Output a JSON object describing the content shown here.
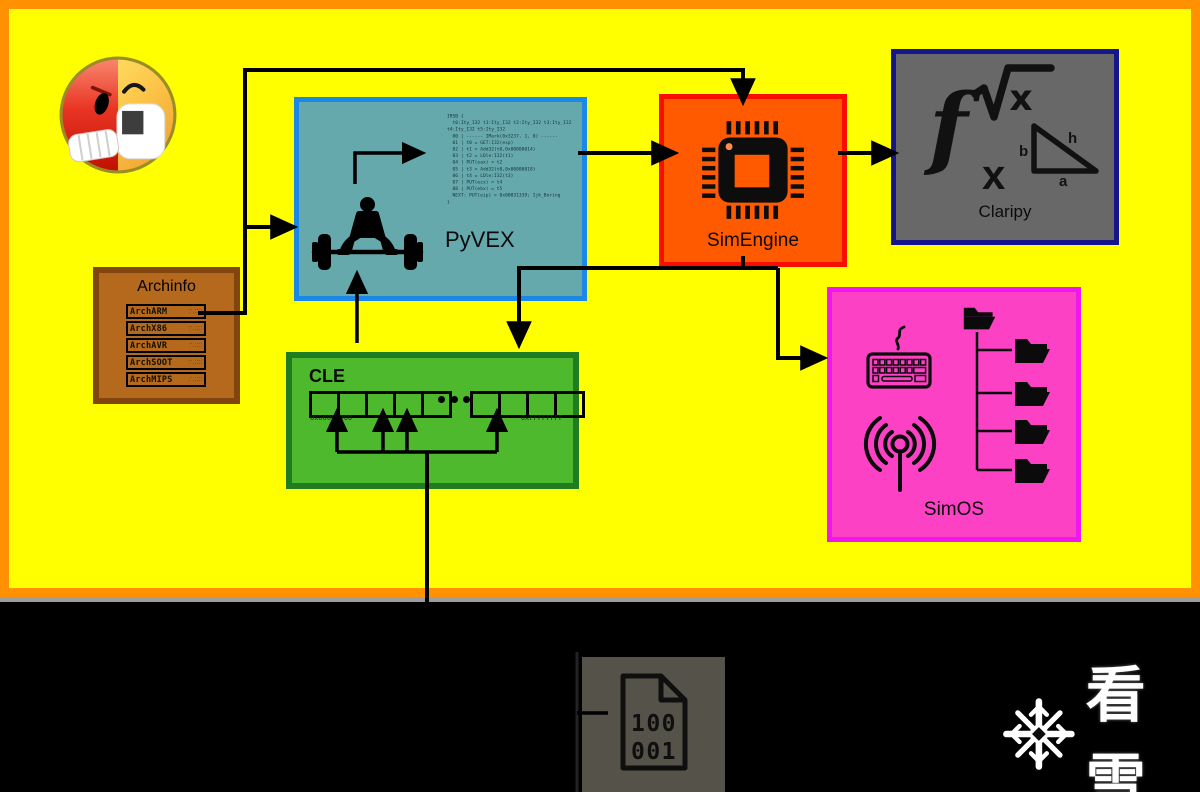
{
  "logo": {
    "icon": "angr-angry-face-icon"
  },
  "archinfo": {
    "title": "Archinfo",
    "rows": [
      {
        "label": "ArchARM",
        "detail": [
          "·· ····",
          "· ·····"
        ]
      },
      {
        "label": "ArchX86",
        "detail": [
          "·· ····",
          "· ·····"
        ]
      },
      {
        "label": "ArchAVR",
        "detail": [
          "·· ····",
          "· ·····"
        ]
      },
      {
        "label": "ArchSOOT",
        "detail": [
          "·· ····",
          "· ·····"
        ]
      },
      {
        "label": "ArchMIPS",
        "detail": [
          "·· ····",
          "· ·····"
        ]
      }
    ]
  },
  "pyvex": {
    "label": "PyVEX",
    "icon": "weightlifter-icon",
    "code": [
      "IRSB {",
      "  t0:Ity_I32 t1:Ity_I32 t2:Ity_I32 t3:Ity_I32",
      "t4:Ity_I32 t5:Ity_I32",
      "  00 | ------ IMark(0x3237, 1, 0) ------",
      "  01 | t0 = GET:I32(esp)",
      "  02 | t1 = Add32(t0,0x00000014)",
      "  03 | t2 = LDle:I32(t1)",
      "  04 | PUT(eax) = t2",
      "  05 | t3 = Add32(t0,0x00000018)",
      "  06 | t4 = LDle:I32(t3)",
      "  07 | PUT(ecx) = t4",
      "  08 | PUT(ebx) = t5",
      "  NEXT: PUT(eip) = 0x00031339; Ijk_Boring",
      "}"
    ]
  },
  "simengine": {
    "label": "SimEngine",
    "icon": "cpu-chip-icon"
  },
  "claripy": {
    "label": "Claripy",
    "icons": [
      "fx-function-icon",
      "sqrt-x-icon",
      "right-triangle-icon"
    ],
    "fx": "f",
    "fx_sub": "x",
    "sqrt_x": "x",
    "triangle": {
      "b": "b",
      "h": "h",
      "a": "a"
    }
  },
  "cle": {
    "label": "CLE",
    "icon": "memory-segments-icon",
    "addr_low": "0x00000000",
    "addr_high": "0xFFFFFFFF"
  },
  "simos": {
    "label": "SimOS",
    "icons": [
      "keyboard-icon",
      "antenna-signal-icon",
      "folder-tree-icon"
    ]
  },
  "binary_file": {
    "icon": "binary-file-icon",
    "line1": "100",
    "line2": "001"
  },
  "watermark": {
    "icon": "snowflake-icon",
    "text": "看雪"
  },
  "colors": {
    "background": "#FFFF00",
    "frame": "#FF9102",
    "pyvex_fill": "#66A9AD",
    "pyvex_border": "#1B87E6",
    "simengine_fill": "#FF5A00",
    "simengine_border": "#F90D00",
    "claripy_fill": "#686868",
    "claripy_border": "#16168C",
    "cle_fill": "#4FB92D",
    "cle_border": "#1F7D1F",
    "simos_fill": "#FC41C5",
    "simos_border": "#EF16EF",
    "archinfo_fill": "#B4691D",
    "archinfo_border": "#814610",
    "bottom_bg": "#000000",
    "binary_panel": "#555349"
  }
}
